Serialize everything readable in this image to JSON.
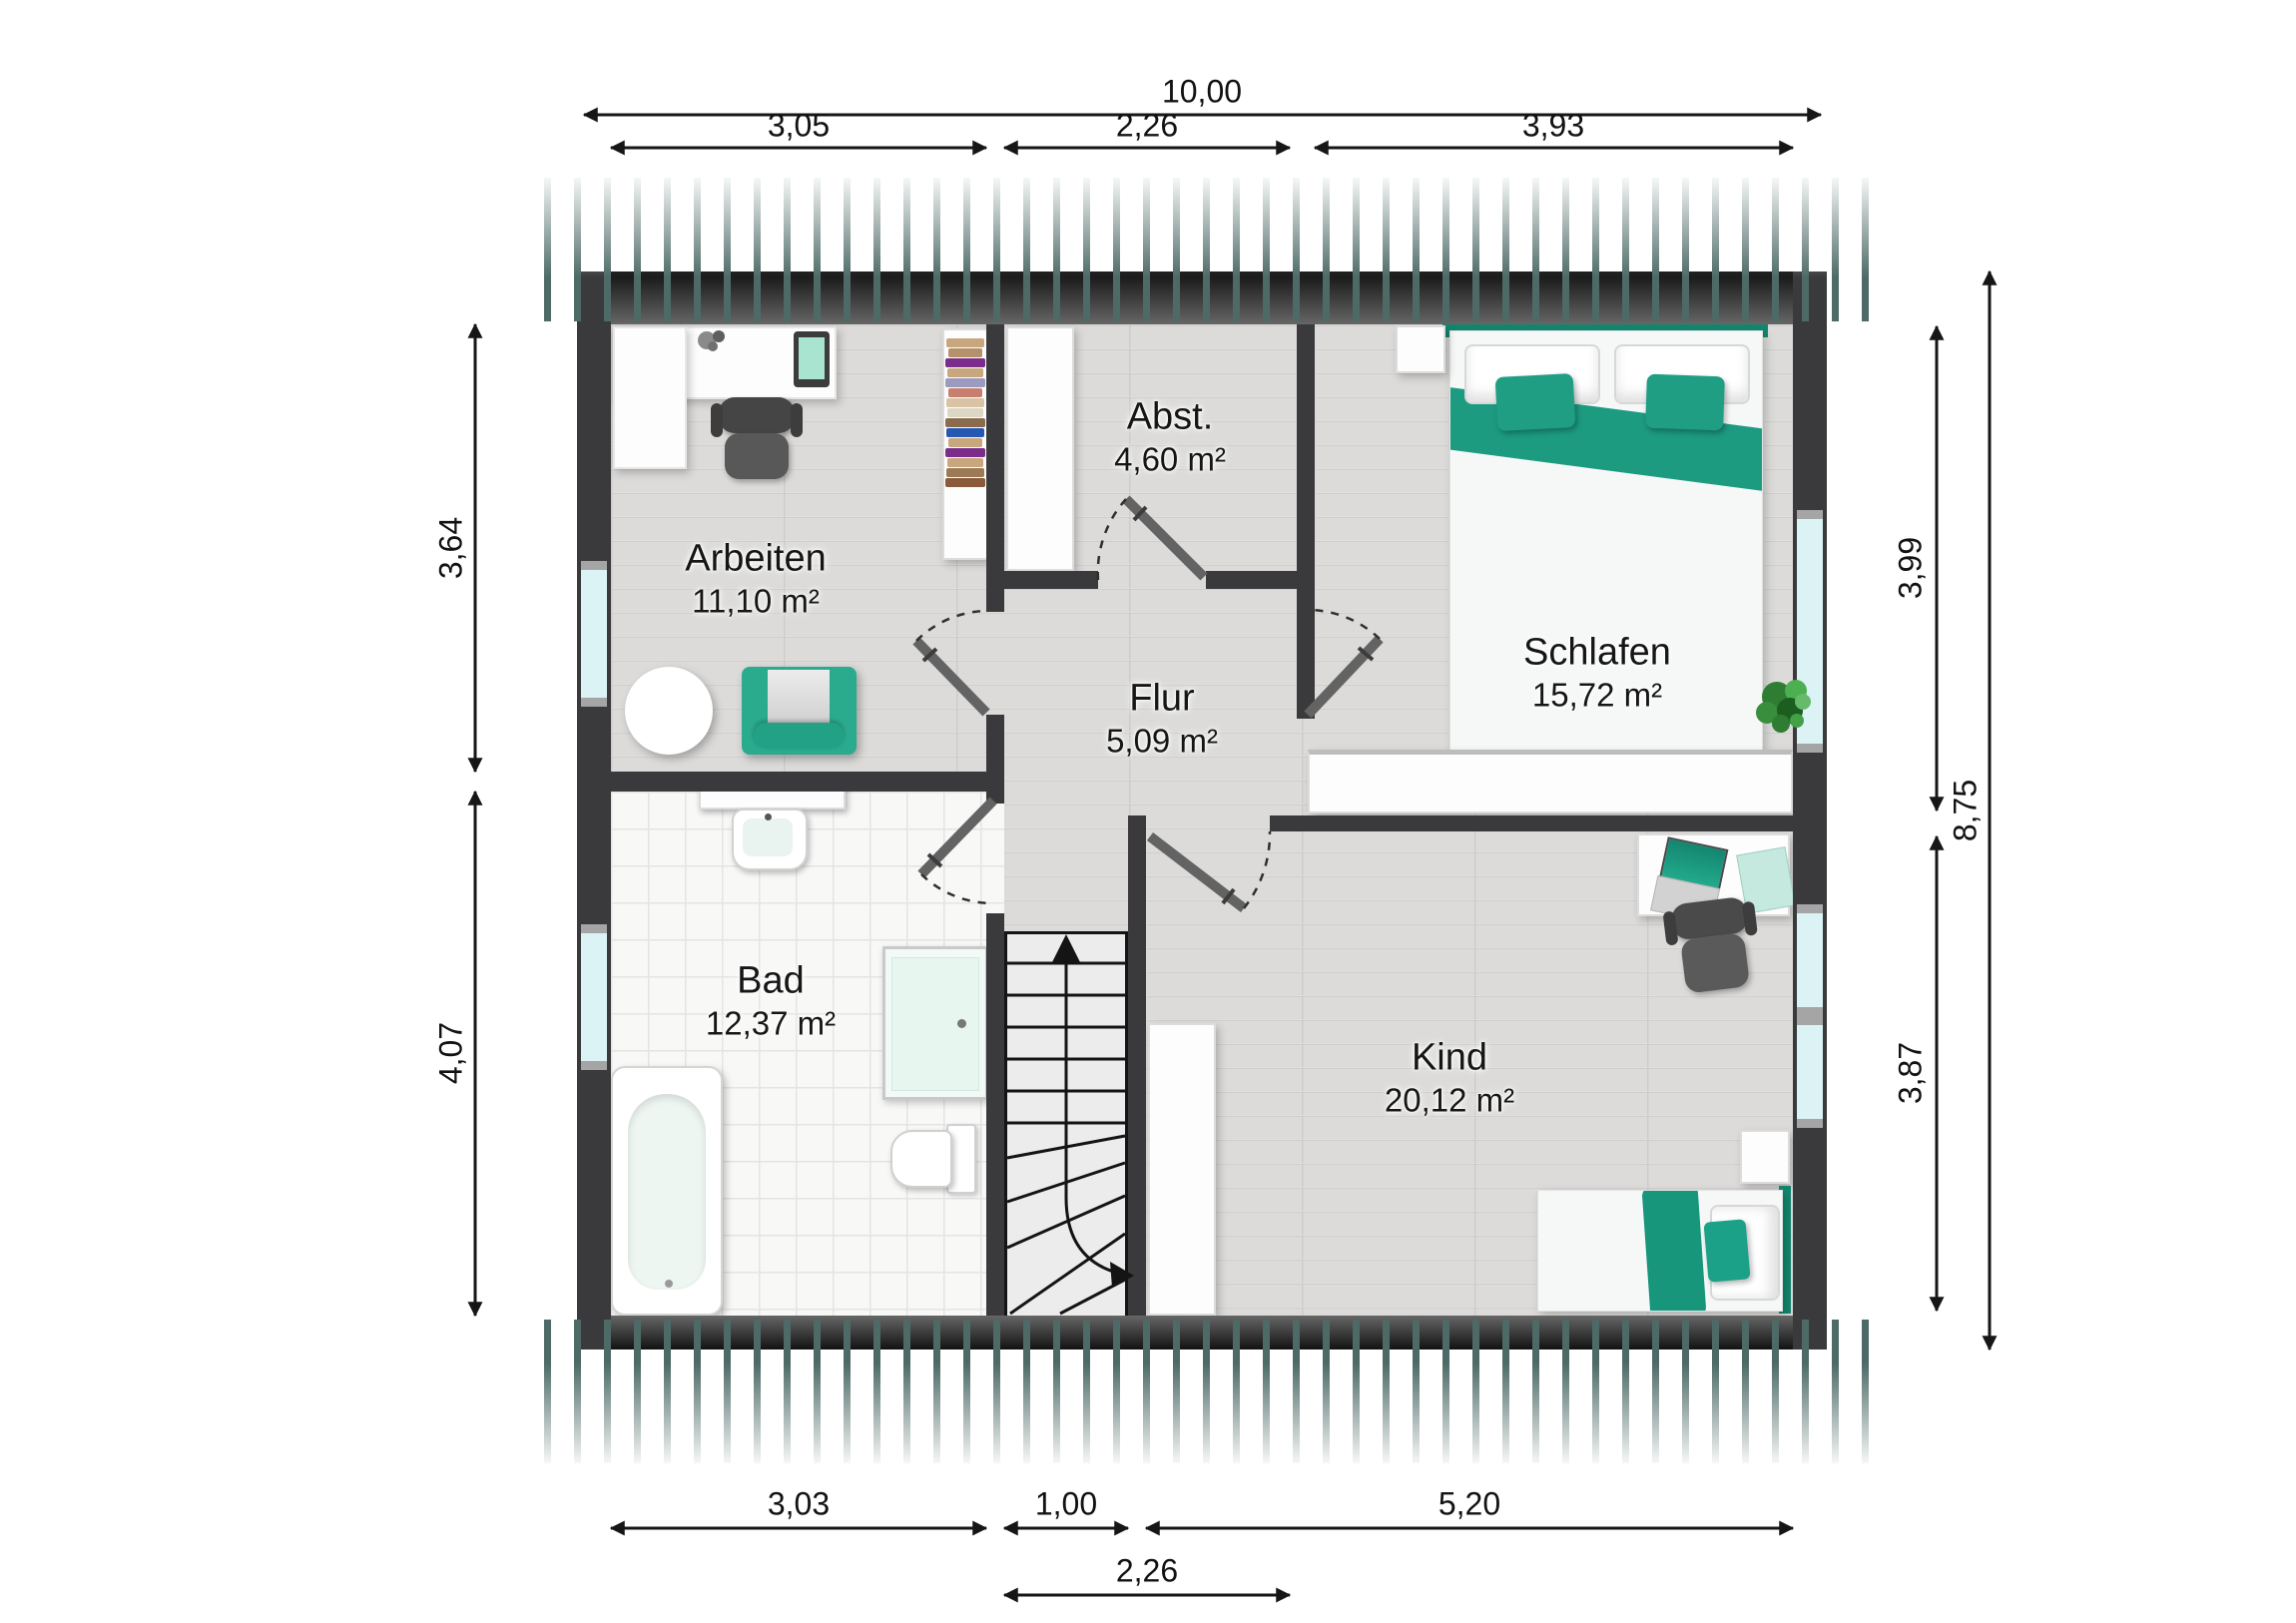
{
  "rooms": [
    {
      "id": "arbeiten",
      "name": "Arbeiten",
      "area": "11,10 m²"
    },
    {
      "id": "abstellraum",
      "name": "Abst.",
      "area": "4,60 m²"
    },
    {
      "id": "schlafen",
      "name": "Schlafen",
      "area": "15,72 m²"
    },
    {
      "id": "flur",
      "name": "Flur",
      "area": "5,09 m²"
    },
    {
      "id": "bad",
      "name": "Bad",
      "area": "12,37 m²"
    },
    {
      "id": "kind",
      "name": "Kind",
      "area": "20,12 m²"
    }
  ],
  "dimensions": {
    "top_total": "10,00",
    "top_segments": [
      "3,05",
      "2,26",
      "3,93"
    ],
    "bottom_segments": [
      "3,03",
      "1,00",
      "5,20"
    ],
    "bottom_overall_segment": "2,26",
    "left_segments": [
      "3,64",
      "4,07"
    ],
    "right_segments": [
      "3,99",
      "3,87"
    ],
    "right_total": "8,75"
  },
  "colors": {
    "accent_teal": "#1f9e83",
    "wall": "#3a3a3c",
    "roof_stripe": "#4d6a66",
    "window_glass": "#dbf3f5",
    "floor_wood": "#dcdbd9",
    "floor_tile": "#f8f8f7"
  },
  "furniture_icons": {
    "arbeiten": [
      "desk",
      "monitor",
      "office-chair",
      "bookshelf",
      "side-table",
      "armchair"
    ],
    "abstellraum": [
      "storage-cabinet"
    ],
    "schlafen": [
      "double-bed",
      "pillows",
      "cushions",
      "nightstand",
      "wardrobe",
      "plant"
    ],
    "bad": [
      "vanity",
      "sink",
      "shower",
      "bathtub",
      "toilet"
    ],
    "kind": [
      "desk",
      "laptop",
      "folder",
      "office-chair",
      "wardrobe",
      "single-bed",
      "nightstand"
    ],
    "flur": [
      "staircase",
      "door-swings"
    ]
  }
}
